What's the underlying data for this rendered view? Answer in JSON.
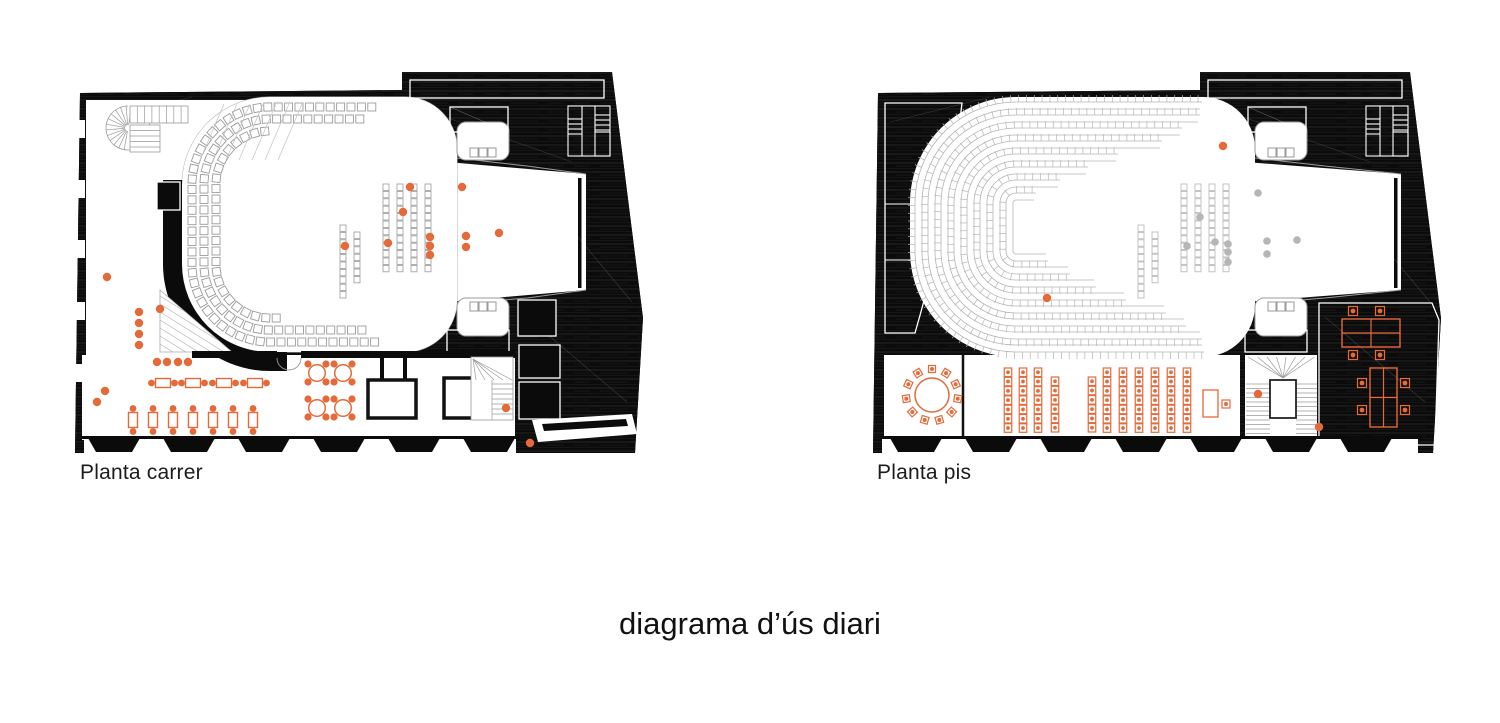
{
  "caption": "diagrama d’ús diari",
  "colors": {
    "accent": "#e56a3a",
    "black": "#0b0b0b",
    "seat_carrer": "#9b9b9b",
    "seat_pis": "#b5b5b5",
    "gray_dot": "#b5b5b5",
    "hall_line": "#b0b0b0",
    "white": "#ffffff"
  },
  "shared": {
    "footprint": "M8,31 L330,28 L330,10 L540,10 L571,256 L563,391 L3,391 Z",
    "band_rect": [
      338,
      18,
      194,
      18
    ],
    "small_rect": [
      378,
      45,
      58,
      25
    ],
    "under_band": [
      375,
      268,
      62,
      22
    ],
    "lobe_top": [
      385,
      60,
      52,
      38
    ],
    "lobe_bot": [
      385,
      236,
      52,
      38
    ],
    "llotja_top": [
      398,
      86
    ],
    "llotja_bot": [
      398,
      240
    ],
    "stair_glyph": [
      496,
      44
    ],
    "columns": [
      {
        "x": 271,
        "y": 163,
        "n": 10
      },
      {
        "x": 285,
        "y": 170,
        "n": 7
      },
      {
        "x": 314,
        "y": 122,
        "n": 12
      },
      {
        "x": 328,
        "y": 122,
        "n": 12
      },
      {
        "x": 342,
        "y": 122,
        "n": 12
      },
      {
        "x": 356,
        "y": 122,
        "n": 12
      }
    ],
    "column_pitch": 7.4
  },
  "plans": [
    {
      "id": "carrer",
      "label": "Planta carrer",
      "hall": {
        "x": 110,
        "y": 35,
        "w": 275,
        "h": 255,
        "rl": 88,
        "rr": 52
      },
      "rows": {
        "style": "squares",
        "size": 8,
        "pitch": 10.4,
        "list": [
          {
            "off": 10,
            "top": 305,
            "bot": 308
          },
          {
            "off": 22,
            "top": 293,
            "bot": 296
          },
          {
            "off": 34,
            "top": 195,
            "bot": 212
          }
        ]
      },
      "stage": {
        "right": 514,
        "bar": 506
      },
      "dots_accent": [
        [
          35,
          215
        ],
        [
          25,
          340
        ],
        [
          33,
          329
        ],
        [
          85,
          300
        ],
        [
          95,
          300
        ],
        [
          106,
          300
        ],
        [
          116,
          300
        ],
        [
          67,
          250
        ],
        [
          67,
          261
        ],
        [
          67,
          272
        ],
        [
          67,
          283
        ],
        [
          88,
          247
        ],
        [
          273,
          184
        ],
        [
          316,
          181
        ],
        [
          331,
          150
        ],
        [
          358,
          175
        ],
        [
          358,
          184
        ],
        [
          358,
          193
        ],
        [
          338,
          125
        ],
        [
          390,
          125
        ],
        [
          394,
          174
        ],
        [
          394,
          185
        ],
        [
          427,
          171
        ],
        [
          434,
          346
        ],
        [
          458,
          381
        ]
      ],
      "dots_gray": [],
      "tables_h": {
        "y": 321,
        "xs": [
          91,
          121,
          152,
          183
        ]
      },
      "tables_v": {
        "y": 358,
        "xs": [
          61,
          81,
          101,
          121,
          141,
          161,
          181
        ]
      },
      "round_tables": [
        [
          245,
          311
        ],
        [
          271,
          311
        ],
        [
          245,
          346
        ],
        [
          271,
          346
        ]
      ]
    },
    {
      "id": "pis",
      "label": "Planta pis",
      "hall": {
        "x": 40,
        "y": 35,
        "w": 345,
        "h": 260,
        "rl": 106,
        "rr": 52
      },
      "rows": {
        "style": "bands",
        "size": 7,
        "pitch": 7.8,
        "list": [
          {
            "off": 5,
            "top": 332,
            "bot": 334
          },
          {
            "off": 18,
            "top": 330,
            "bot": 332
          },
          {
            "off": 31,
            "top": 312,
            "bot": 316
          },
          {
            "off": 44,
            "top": 292,
            "bot": 296
          },
          {
            "off": 57,
            "top": 248,
            "bot": 256
          },
          {
            "off": 70,
            "top": 218,
            "bot": 226
          },
          {
            "off": 83,
            "top": 190,
            "bot": 200
          },
          {
            "off": 96,
            "top": 166,
            "bot": 178
          }
        ]
      },
      "stage": {
        "right": 531,
        "bar": 524
      },
      "dots_accent": [
        [
          353,
          84
        ],
        [
          177,
          236
        ],
        [
          388,
          332
        ],
        [
          449,
          365
        ]
      ],
      "dots_gray": [
        [
          388,
          131
        ],
        [
          397,
          179
        ],
        [
          427,
          178
        ],
        [
          397,
          192
        ],
        [
          330,
          155
        ],
        [
          317,
          184
        ],
        [
          358,
          182
        ],
        [
          358,
          190
        ],
        [
          358,
          200
        ],
        [
          345,
          180
        ]
      ],
      "round_table_big": {
        "c": [
          62,
          333
        ],
        "r": 17,
        "chairs": 11,
        "chair_r": 26
      },
      "classroom": {
        "desk_w": 7.5,
        "desk_h": 8.5,
        "pitch_y": 9.3,
        "groups": [
          {
            "cols": [
              {
                "x": 138,
                "y": 306,
                "n": 7
              },
              {
                "x": 153,
                "y": 306,
                "n": 7
              },
              {
                "x": 168,
                "y": 306,
                "n": 7
              },
              {
                "x": 185,
                "y": 315,
                "n": 6
              }
            ]
          },
          {
            "cols": [
              {
                "x": 222,
                "y": 315,
                "n": 6
              },
              {
                "x": 237,
                "y": 306,
                "n": 7
              },
              {
                "x": 253,
                "y": 306,
                "n": 7
              },
              {
                "x": 269,
                "y": 306,
                "n": 7
              },
              {
                "x": 285,
                "y": 306,
                "n": 7
              },
              {
                "x": 301,
                "y": 306,
                "n": 7
              },
              {
                "x": 317,
                "y": 306,
                "n": 7
              }
            ]
          }
        ]
      },
      "teacher_desk": {
        "rect": [
          333,
          328,
          15,
          27
        ],
        "chair": [
          352,
          338
        ]
      },
      "office_tables": [
        {
          "rect": [
            472,
            257,
            58,
            28
          ],
          "orient": "h",
          "chairs": [
            [
              483,
              249
            ],
            [
              510,
              249
            ],
            [
              483,
              293
            ],
            [
              510,
              293
            ]
          ]
        },
        {
          "rect": [
            500,
            306,
            27,
            59
          ],
          "orient": "v",
          "chairs": [
            [
              492,
              321
            ],
            [
              535,
              321
            ],
            [
              492,
              348
            ],
            [
              535,
              348
            ]
          ]
        }
      ]
    }
  ]
}
